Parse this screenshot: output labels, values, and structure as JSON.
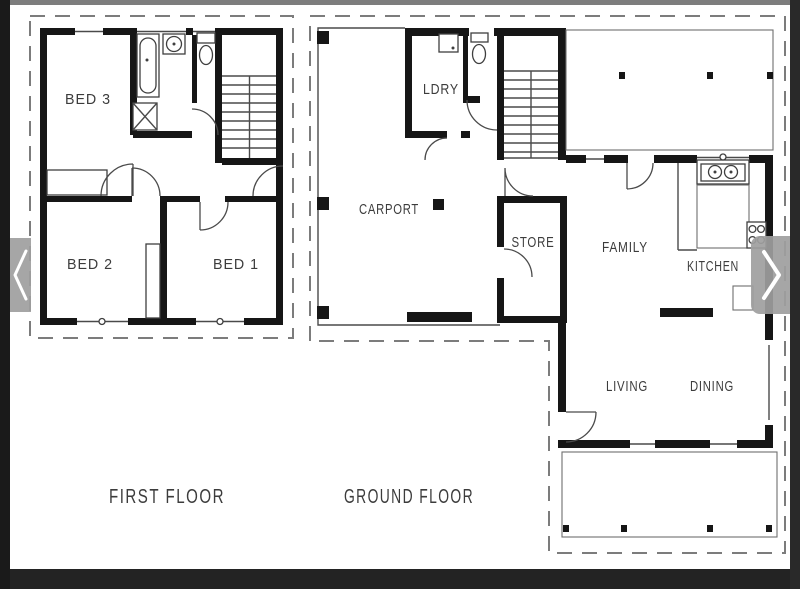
{
  "viewer": {
    "colors": {
      "letterbox": "#232323",
      "left_edge": "#1a1a1a",
      "right_edge": "#292929",
      "top_strip": "#7d7d7d",
      "nav_strip": "#9e9e9e",
      "paper": "#ffffff",
      "wall_line": "#161616",
      "roof_dashed_line": "#7c7c7c",
      "label_text": "#3c3c3c"
    },
    "nav": {
      "prev_icon": "chevron-left",
      "next_icon": "chevron-right"
    }
  },
  "plans": {
    "first_floor": {
      "title": "FIRST FLOOR",
      "rooms": {
        "bed3": "BED 3",
        "bed2": "BED 2",
        "bed1": "BED 1"
      }
    },
    "ground_floor": {
      "title": "GROUND FLOOR",
      "rooms": {
        "laundry": "LDRY",
        "carport": "CARPORT",
        "store": "STORE",
        "family": "FAMILY",
        "kitchen": "KITCHEN",
        "living": "LIVING",
        "dining": "DINING"
      }
    }
  }
}
